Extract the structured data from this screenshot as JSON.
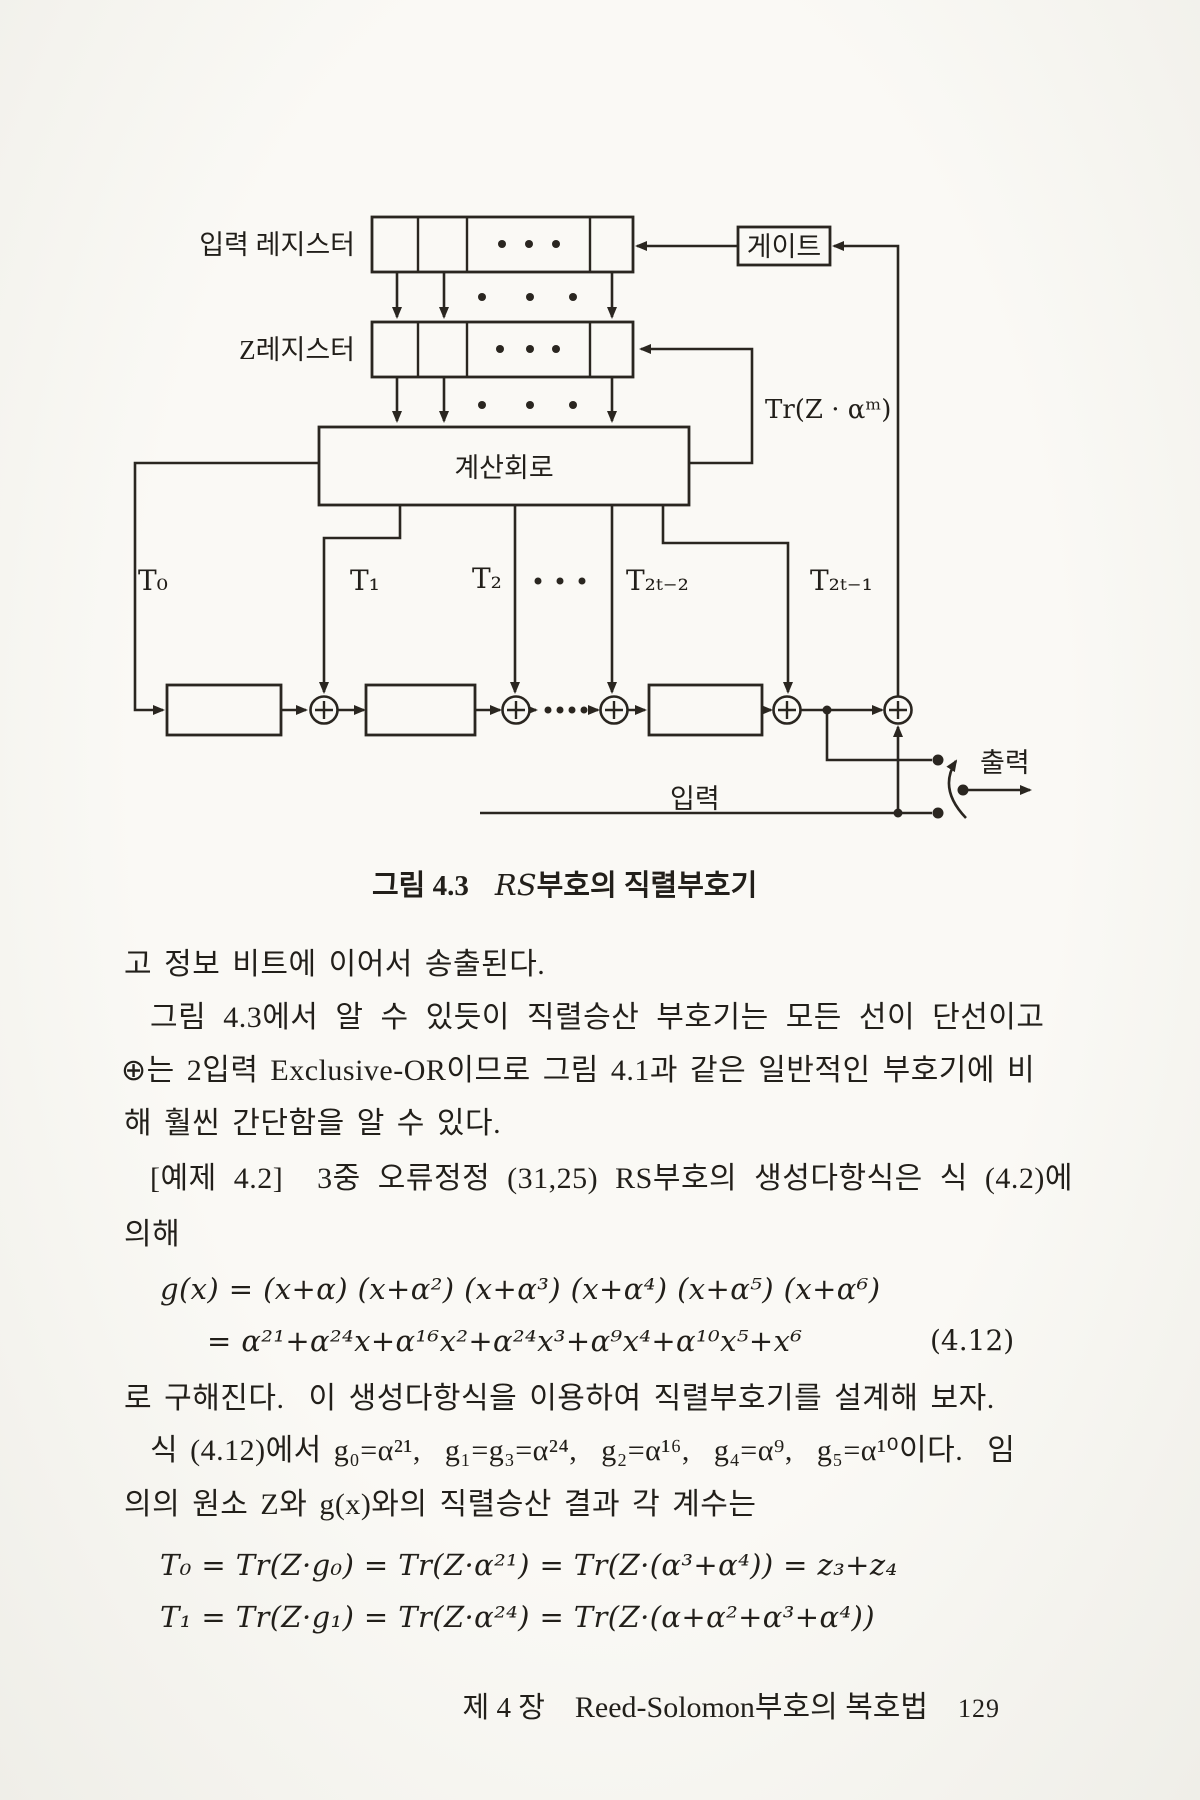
{
  "page": {
    "background": "#f5f4ef",
    "ink": "#2a2620"
  },
  "diagram": {
    "labels": {
      "input_register": "입력 레지스터",
      "z_register": "Z레지스터",
      "gate": "게이트",
      "trace": "Tr(Z · αᵐ)",
      "calc_circuit": "계산회로",
      "t0": "T₀",
      "t1": "T₁",
      "t2": "T₂",
      "t2t_minus2": "T₂ₜ₋₂",
      "t2t_minus1": "T₂ₜ₋₁",
      "input": "입력",
      "output": "출력"
    }
  },
  "caption": {
    "figure_label": "그림 4.3",
    "title_rs": "RS",
    "title_rest": "부호의 직렬부호기"
  },
  "body": {
    "l1": "고 정보 비트에 이어서 송출된다.",
    "l2": "그림 4.3에서 알 수 있듯이 직렬승산 부호기는 모든 선이 단선이고",
    "l3": "⊕는 2입력 Exclusive-OR이므로 그림 4.1과 같은 일반적인 부호기에 비",
    "l4": "해 훨씬 간단함을 알 수 있다.",
    "l5": "[예제 4.2]  3중 오류정정 (31,25) RS부호의 생성다항식은 식 (4.2)에",
    "l6": "의해",
    "eq1": "g(x) = (x+α) (x+α²) (x+α³) (x+α⁴) (x+α⁵) (x+α⁶)",
    "eq2": "= α²¹+α²⁴x+α¹⁶x²+α²⁴x³+α⁹x⁴+α¹⁰x⁵+x⁶",
    "eq2_number": "(4.12)",
    "l7": "로 구해진다.  이 생성다항식을 이용하여 직렬부호기를 설계해 보자.",
    "l8": "식 (4.12)에서 g₀=α²¹,  g₁=g₃=α²⁴,  g₂=α¹⁶,  g₄=α⁹,  g₅=α¹⁰이다.  임",
    "l9": "의의 원소 Z와 g(x)와의 직렬승산 결과 각 계수는",
    "eq3": "T₀ = Tr(Z·g₀) = Tr(Z·α²¹) = Tr(Z·(α³+α⁴)) = z₃+z₄",
    "eq4": "T₁ = Tr(Z·g₁) = Tr(Z·α²⁴) = Tr(Z·(α+α²+α³+α⁴))"
  },
  "footer": {
    "chapter": "제 4 장",
    "title": "Reed-Solomon부호의 복호법",
    "page_number": "129"
  }
}
